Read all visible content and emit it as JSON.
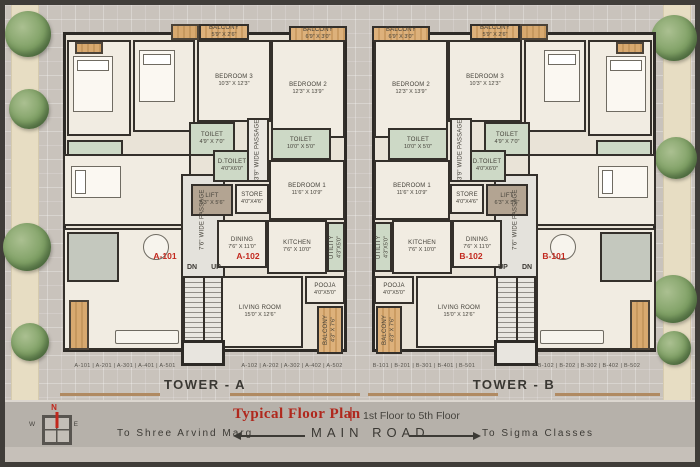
{
  "plan": {
    "title": "Typical Floor Plan",
    "separator": "|",
    "subtitle": "1st Floor to 5th Floor"
  },
  "road": {
    "name": "MAIN ROAD",
    "to_left": "To  Shree  Arvind  Marg",
    "to_right": "To  Sigma  Classes"
  },
  "compass": {
    "north": "N",
    "south": "S",
    "east": "E",
    "west": "W"
  },
  "stair": {
    "down": "DN",
    "up": "UP"
  },
  "towers": [
    {
      "name": "TOWER - A",
      "unit_label_1": "A-101",
      "unit_label_2": "A-102",
      "units_row_left": "A-101  |  A-201  |  A-301  |  A-401  |  A-501",
      "units_row_right": "A-102  |  A-202  |  A-302  |  A-402  |  A-502"
    },
    {
      "name": "TOWER - B",
      "unit_label_1": "B-101",
      "unit_label_2": "B-102",
      "units_row_left": "B-101  |  B-201  |  B-301  |  B-401  |  B-501",
      "units_row_right": "B-102  |  B-202  |  B-302  |  B-402  |  B-502"
    }
  ],
  "rooms": [
    {
      "id": "balcony_mid",
      "name": "BALCONY",
      "dims": "5'9\" X 2'6\"",
      "kind": "balcony"
    },
    {
      "id": "balcony_outer",
      "name": "BALCONY",
      "dims": "6'9\" X 3'0\"",
      "kind": "balcony"
    },
    {
      "id": "bedroom3",
      "name": "BEDROOM 3",
      "dims": "10'3\" X 12'3\"",
      "kind": "room"
    },
    {
      "id": "bedroom2",
      "name": "BEDROOM 2",
      "dims": "12'3\" X 13'9\"",
      "kind": "room"
    },
    {
      "id": "toilet_small",
      "name": "TOILET",
      "dims": "4'9\" X 7'0\"",
      "kind": "wet"
    },
    {
      "id": "toilet_wide",
      "name": "TOILET",
      "dims": "10'0\" X 5'0\"",
      "kind": "wet"
    },
    {
      "id": "d_toilet",
      "name": "D.TOILET",
      "dims": "4'0\"X6'0\"",
      "kind": "wet"
    },
    {
      "id": "passage_39",
      "name": "3'9\" WIDE PASSAGE",
      "dims": "",
      "kind": "pass",
      "vertical": true
    },
    {
      "id": "lift",
      "name": "LIFT",
      "dims": "6'3\" X 5'6\"",
      "kind": "lift"
    },
    {
      "id": "store",
      "name": "STORE",
      "dims": "4'0\"X4'6\"",
      "kind": "room"
    },
    {
      "id": "bedroom1",
      "name": "BEDROOM 1",
      "dims": "11'6\" X 10'9\"",
      "kind": "room"
    },
    {
      "id": "dining",
      "name": "DINING",
      "dims": "7'6\" X 11'0\"",
      "kind": "room"
    },
    {
      "id": "kitchen",
      "name": "KITCHEN",
      "dims": "7'6\" X 10'0\"",
      "kind": "room"
    },
    {
      "id": "utility",
      "name": "UTILITY",
      "dims": "4'3\"X5'0\"",
      "kind": "wet",
      "vertical": true
    },
    {
      "id": "pooja",
      "name": "POOJA",
      "dims": "4'0\"X5'0\"",
      "kind": "room"
    },
    {
      "id": "living",
      "name": "LIVING ROOM",
      "dims": "15'0\" X 12'6\"",
      "kind": "room"
    },
    {
      "id": "balcony_side",
      "name": "BALCONY",
      "dims": "4'3\" X 7'6\"",
      "kind": "balcony",
      "vertical": true
    },
    {
      "id": "passage_76",
      "name": "7'6\" WIDE PASSAGE",
      "dims": "",
      "kind": "plabel",
      "vertical": true
    }
  ],
  "colors": {
    "accent_red": "#c2281e",
    "wall": "#2d2a26",
    "wet_green": "#cdd9c6",
    "balcony_wood": "#d8a96f",
    "paving": "#c9c3bc",
    "road": "#b6b1aa"
  }
}
